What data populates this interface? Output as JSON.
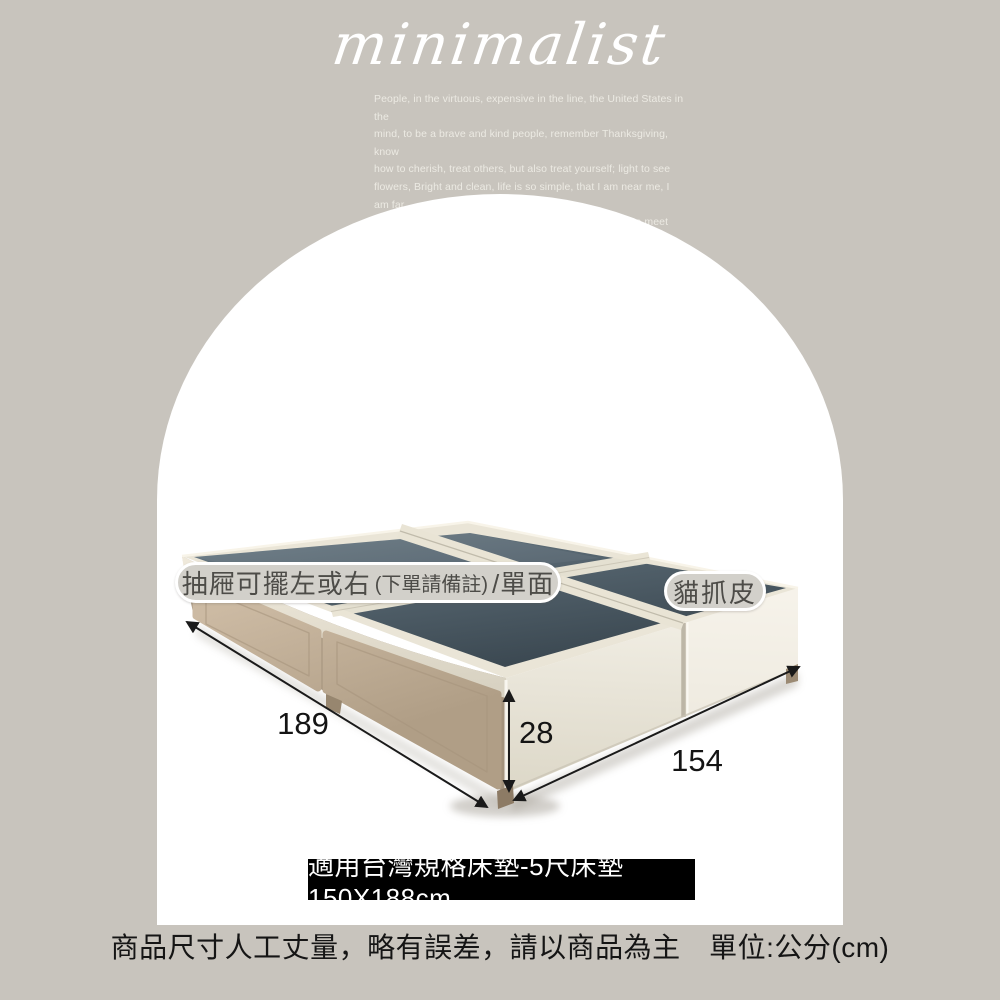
{
  "header": {
    "brand_script": "minimalist",
    "intro": "People, in the virtuous, expensive in the line, the United States in the\nmind, to be a brave and kind people, remember Thanksgiving, know\nhow to cherish, treat others, but also treat yourself; light to see\nflowers, Bright and clean, life is so simple, that I am near me, I am far\naway from me, I believe that I understand, grateful life to meet\neveryone"
  },
  "callouts": {
    "drawer_main": "抽屜可擺左或右",
    "drawer_note": "(下單請備註)",
    "drawer_suffix": "/單面",
    "material": "貓抓皮"
  },
  "dimensions": {
    "length_cm": "189",
    "height_cm": "28",
    "width_cm": "154"
  },
  "banner": {
    "text": "適用台灣規格床墊-5尺床墊150X188cm"
  },
  "footer": {
    "note": "商品尺寸人工丈量，略有誤差，請以商品為主　單位:公分(cm)"
  },
  "colors": {
    "background": "#c8c4bd",
    "arch": "#ffffff",
    "banner_bg": "#000000",
    "banner_text": "#ffffff",
    "pill_bg": "#d2d0ca",
    "pill_border": "#ffffff",
    "pill_text": "#4d4c48",
    "bed_top_panel": "#42505a",
    "bed_frame_fabric": "#eae5d7",
    "drawer_fabric": "#c2b098",
    "dimension_line": "#1a1a1a"
  }
}
